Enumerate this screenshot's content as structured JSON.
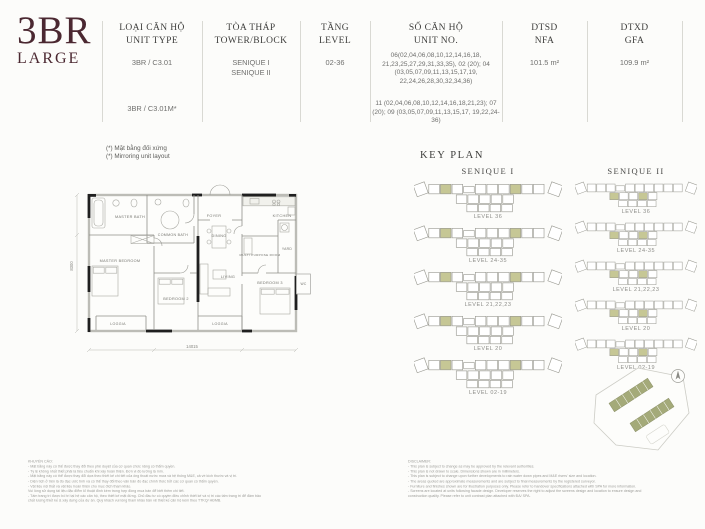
{
  "title": {
    "main": "3BR",
    "sub": "LARGE"
  },
  "header": {
    "columns": [
      {
        "label_vi": "LOẠI CĂN HỘ",
        "label_en": "UNIT TYPE",
        "values": [
          "3BR / C3.01",
          "3BR / C3.01M*"
        ]
      },
      {
        "label_vi": "TÒA THÁP",
        "label_en": "TOWER/BLOCK",
        "values": [
          "SENIQUE I",
          "SENIQUE II"
        ]
      },
      {
        "label_vi": "TẦNG",
        "label_en": "LEVEL",
        "values": [
          "02-36"
        ]
      },
      {
        "label_vi": "SỐ CĂN HỘ",
        "label_en": "UNIT NO.",
        "values": [
          "06(02,04,06,08,10,12,14,16,18, 21,23,25,27,29,31,33,35), 02 (20); 04 (03,05,07,09,11,13,15,17,19, 22,24,26,28,30,32,34,36)",
          "11 (02,04,06,08,10,12,14,16,18,21,23); 07 (20); 09 (03,05,07,09,11,13,15,17, 19,22,24-36)"
        ]
      },
      {
        "label_vi": "DTSD",
        "label_en": "NFA",
        "values": [
          "101.5 m²"
        ]
      },
      {
        "label_vi": "DTXD",
        "label_en": "GFA",
        "values": [
          "109.9 m²"
        ]
      }
    ],
    "notes": [
      "(*) Mặt bằng đối xứng",
      "(*) Mirroring unit layout"
    ]
  },
  "floor_plan": {
    "rooms": [
      "MASTER BATH",
      "COMMON BATH",
      "FOYER",
      "DINING",
      "KITCHEN",
      "YARD",
      "MULTI PURPOSE ROOM",
      "LIVING",
      "BEDROOM 2",
      "BEDROOM 3",
      "LOGGIA",
      "LOGGIA",
      "WC",
      "MASTER BEDROOM"
    ],
    "dimensions": {
      "width": "14015",
      "height": "8300"
    }
  },
  "key_plan": {
    "heading": "KEY PLAN",
    "towers": [
      {
        "name": "SENIQUE I",
        "levels": [
          "LEVEL 36",
          "LEVEL 24-35",
          "LEVEL 21,22,23",
          "LEVEL 20",
          "LEVEL 02-19"
        ]
      },
      {
        "name": "SENIQUE II",
        "levels": [
          "LEVEL 36",
          "LEVEL 24-35",
          "LEVEL 21,22,23",
          "LEVEL 20",
          "LEVEL 02-19"
        ]
      }
    ]
  },
  "footer": {
    "vi": {
      "heading": "KHUYẾN CÁO:",
      "lines": [
        "-  Mặt bằng này có thể được thay đổi theo phê duyệt của cơ quan chức năng có thẩm quyền.",
        "-  Tỷ lệ không nhất thiết phải là tiêu chuẩn khi xây hoàn thiện. Đơn vị đo lường là mm.",
        "-  Mặt bằng này có thể được thay đổi dựa theo thiết kế chi tiết của ống thoát nước mưa và hệ thống M&E, cả về kích thước và vị trí.",
        "-  Diện tích ở trên là đo đạc ước tính và có thể thay đổi theo văn bản đo đạc chính thức bởi các cơ quan có thẩm quyền.",
        "-  Vật liệu nội thất và vật liệu hoàn thiện cho mục đích tham khảo.",
        "   Vui lòng sử dụng tài liệu đặc điểm kĩ thuật đính kèm trong hợp đồng mua bán để biết thêm chi tiết.",
        "-  Tấm trang trí được bố trí tại hệ các căn hộ, theo thiết kế mặt đứng. Chủ đầu tư có quyền điều chỉnh thiết kế và vị trí các tấm trang trí để đảm bảo",
        "   chất lượng thiết kế & xây dựng của dự án. Quý khách vui lòng tham khảo bản vẽ thiết kế căn hộ kèm theo TTKQ/ HĐMB."
      ]
    },
    "en": {
      "heading": "DISCLAIMER:",
      "lines": [
        "-  This plan is subject to change as may be approved by the relevant authorities.",
        "-  This plan is not drawn to scale. Dimensions shown are in millimeters.",
        "-  This plan is subject to change upon further developments to rain water down pipes and M&E risers' size and location.",
        "-  The areas quoted are approximate measurements and are subject to final measurements by the registered surveyor.",
        "-  Furniture and finishes shown are for illustration purposes only. Please refer to handover specifications attached with SPA for more information.",
        "-  Screens are located at units following facade design. Developer reserves the right to adjust the screens design and location to ensure design and",
        "   construction quality. Please refer to unit contrast plan attached with ĐA/ SPA."
      ]
    }
  },
  "colors": {
    "accent": "#4b2831",
    "key_highlight": "#c6c795",
    "site_building": "#a4aa79"
  }
}
